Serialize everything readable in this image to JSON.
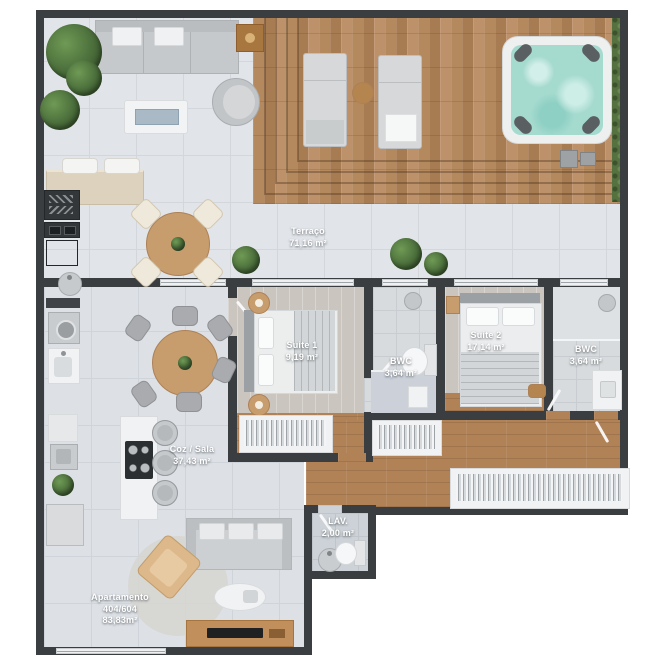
{
  "rooms": {
    "terraco": {
      "name": "Terraço",
      "area": "71,16 m²"
    },
    "suite1": {
      "name": "Suite 1",
      "area": "9,19 m²"
    },
    "bwc1": {
      "name": "BWC",
      "area": "3,64 m²"
    },
    "suite2": {
      "name": "Suite 2",
      "area": "17,14 m²"
    },
    "bwc2": {
      "name": "BWC",
      "area": "3,64 m²"
    },
    "coz_sala": {
      "name": "Coz / Sala",
      "area": "37,43 m²"
    },
    "lav": {
      "name": "LAV.",
      "area": "2,00 m²"
    },
    "apartment": {
      "name": "Apartamento",
      "unit": "404/604",
      "area": "83,83m²"
    }
  },
  "colors": {
    "wall": "#3a3e41",
    "terrace_tile": "#e1e4e8",
    "interior_tile": "#dde1e6",
    "deck_wood": "#b5895e",
    "hall_wood": "#b28257",
    "suite_floor": "#cbc5bf",
    "bathroom_tile": "#d7dbde",
    "hot_tub_water": "#a5dacf",
    "hedge": "#54713f",
    "furniture_wood": "#c79d6d",
    "label_text": "#ffffff"
  },
  "furniture": [
    "sofa",
    "hot-tub",
    "sun-lounger",
    "outdoor-dining-table",
    "barbecue-grill",
    "outdoor-counter",
    "round-dining-table",
    "kitchen-island-cooktop",
    "bar-stool",
    "double-bed",
    "nightstand",
    "wardrobe",
    "toilet",
    "shower",
    "washbasin",
    "washing-machine",
    "laundry-tub",
    "tv-console",
    "armchair",
    "rug",
    "coffee-table",
    "plant",
    "hedge",
    "deck-steps"
  ]
}
